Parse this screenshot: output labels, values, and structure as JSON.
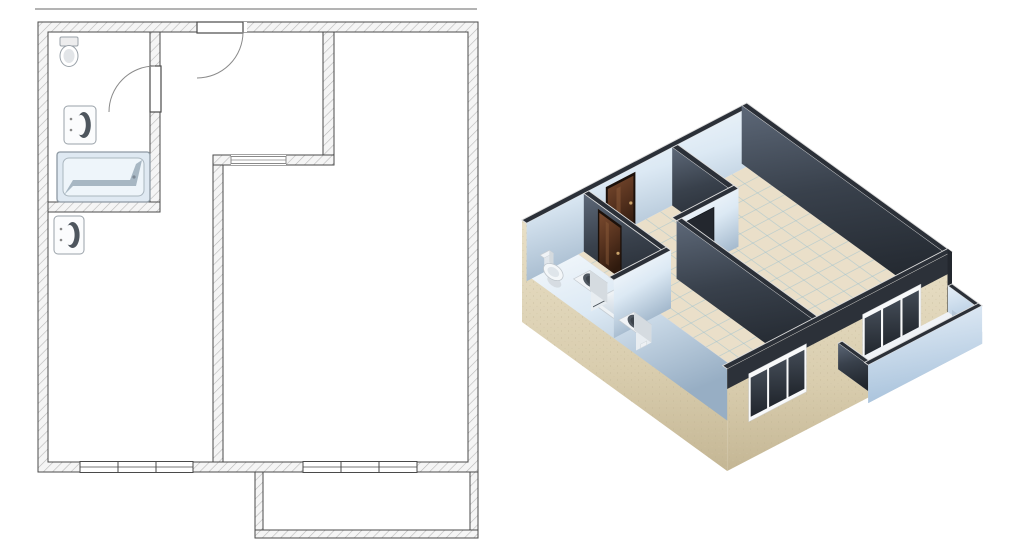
{
  "scene": {
    "width": 1024,
    "height": 539,
    "background": "#ffffff"
  },
  "plan": {
    "origin_2d": [
      38,
      22
    ],
    "outer_width": 440,
    "outer_height": 450,
    "wall_thickness": 10,
    "top_rule": {
      "y": 9,
      "x1": 35,
      "x2": 477
    },
    "inner_walls": [
      {
        "id": "bathroom-right-wall",
        "rect": [
          112,
          10,
          10,
          180
        ]
      },
      {
        "id": "bathroom-bottom-wall",
        "rect": [
          10,
          180,
          112,
          10
        ]
      },
      {
        "id": "hall-right-wall",
        "rect": [
          285,
          10,
          11,
          123
        ]
      },
      {
        "id": "hall-bottom-wall",
        "rect": [
          175,
          133,
          121,
          10
        ]
      },
      {
        "id": "kitchen-living-wall",
        "rect": [
          175,
          143,
          10,
          297
        ]
      }
    ],
    "entry_door": {
      "x1": 159,
      "x2": 209,
      "leaf": 46
    },
    "bathroom_door": {
      "y1": 44,
      "y2": 90,
      "leaf": 46
    },
    "hall_opening": {
      "x1": 193,
      "x2": 248
    },
    "windows": [
      {
        "id": "window-left",
        "x1": 42,
        "x2": 155,
        "mullions": [
          80,
          118
        ]
      },
      {
        "id": "window-right",
        "x1": 265,
        "x2": 379,
        "mullions": [
          303,
          341
        ]
      }
    ],
    "balcony": {
      "x": 217,
      "y": 450,
      "w": 223,
      "d": 66,
      "wall_thickness": 8
    },
    "fixtures": [
      {
        "id": "toilet",
        "rect": [
          22,
          15,
          18,
          28
        ]
      },
      {
        "id": "bathroom-sink",
        "rect": [
          26,
          84,
          32,
          38
        ]
      },
      {
        "id": "bathtub",
        "rect": [
          19,
          130,
          93,
          50
        ]
      },
      {
        "id": "kitchen-sink",
        "rect": [
          16,
          194,
          30,
          38
        ]
      }
    ]
  },
  "projection": {
    "origin": [
      522,
      278
    ],
    "ux": 0.511,
    "uy": -0.266,
    "vx": 0.456,
    "vy": 0.331,
    "wall_height": 58,
    "slab_depth": 44,
    "parapet_height": 26,
    "tile_step": 28,
    "door_height": 50,
    "window_z": [
      -6,
      42
    ]
  },
  "palette": {
    "line": "#4a4a4a",
    "thin_line": "#8a8a8a",
    "hatch_bg": "#f5f5f5",
    "hatch_line": "#b8b8b8",
    "rule_gray": "#b3b3b3",
    "tub_fill": "#dfe9f2",
    "tub_inner": "#eef5fa",
    "tub_shade": "#8fa2b0",
    "tub_stroke": "#8d99a3",
    "fixture_fill": "#fbfcfd",
    "fixture_stroke": "#9aa2a9",
    "basin_dark": "#4e565e",
    "wall_top": "#2b3038",
    "wall_top_line": "#dcdcdc",
    "dark_hi": "#5d6878",
    "dark_mid": "#39414c",
    "dark_lo": "#20252c",
    "gloss_hi": "#ffffff",
    "gloss_mid": "#dce9f4",
    "gloss_lo": "#97aec4",
    "floor": "#eadfc9",
    "floor_grid": "#9fc3cf",
    "ext_hi": "#e8dfc6",
    "ext_mid": "#d9cdae",
    "ext_lo": "#c4b694",
    "door_hi": "#7a4a2e",
    "door_mid": "#53301d",
    "door_lo": "#2f1a0e",
    "door_frame": "#1b100a",
    "door_knob": "#caa36a",
    "balc_hi": "#e6eff8",
    "balc_lo": "#a9c3dc",
    "balc_slab": "#c6d4e2",
    "balc_slab2": "#b4c6d8",
    "win_frame": "#f8f9fa",
    "win_pane_hi": "#434b56",
    "win_pane_lo": "#20252c",
    "end_cap": "#e9eff4",
    "opening_dark": "#23272e",
    "balcony_floor": "#eff2f6"
  }
}
